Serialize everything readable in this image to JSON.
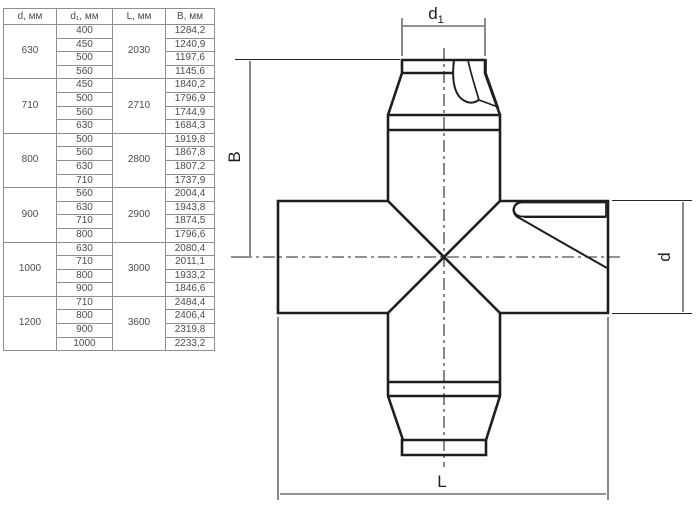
{
  "table": {
    "headers": [
      "d, мм",
      "d₁, мм",
      "L, мм",
      "B, мм"
    ],
    "groups": [
      {
        "d": "630",
        "L": "2030",
        "rows": [
          [
            "400",
            "1284,2"
          ],
          [
            "450",
            "1240,9"
          ],
          [
            "500",
            "1197,6"
          ],
          [
            "560",
            "1145,6"
          ]
        ]
      },
      {
        "d": "710",
        "L": "2710",
        "rows": [
          [
            "450",
            "1840,2"
          ],
          [
            "500",
            "1796,9"
          ],
          [
            "560",
            "1744,9"
          ],
          [
            "630",
            "1684,3"
          ]
        ]
      },
      {
        "d": "800",
        "L": "2800",
        "rows": [
          [
            "500",
            "1919,8"
          ],
          [
            "560",
            "1867,8"
          ],
          [
            "630",
            "1807,2"
          ],
          [
            "710",
            "1737,9"
          ]
        ]
      },
      {
        "d": "900",
        "L": "2900",
        "rows": [
          [
            "560",
            "2004,4"
          ],
          [
            "630",
            "1943,8"
          ],
          [
            "710",
            "1874,5"
          ],
          [
            "800",
            "1796,6"
          ]
        ]
      },
      {
        "d": "1000",
        "L": "3000",
        "rows": [
          [
            "630",
            "2080,4"
          ],
          [
            "710",
            "2011,1"
          ],
          [
            "800",
            "1933,2"
          ],
          [
            "900",
            "1846,6"
          ]
        ]
      },
      {
        "d": "1200",
        "L": "3600",
        "rows": [
          [
            "710",
            "2484,4"
          ],
          [
            "800",
            "2406,4"
          ],
          [
            "900",
            "2319,8"
          ],
          [
            "1000",
            "2233,2"
          ]
        ]
      }
    ]
  },
  "drawing": {
    "labels": {
      "d1_base": "d",
      "d1_sub": "1",
      "B": "B",
      "d": "d",
      "L": "L"
    }
  },
  "colors": {
    "background": "#ffffff",
    "drawing_line": "#1e1e1e",
    "table_border": "#8f8f8f",
    "table_text": "#4c4c4c"
  }
}
